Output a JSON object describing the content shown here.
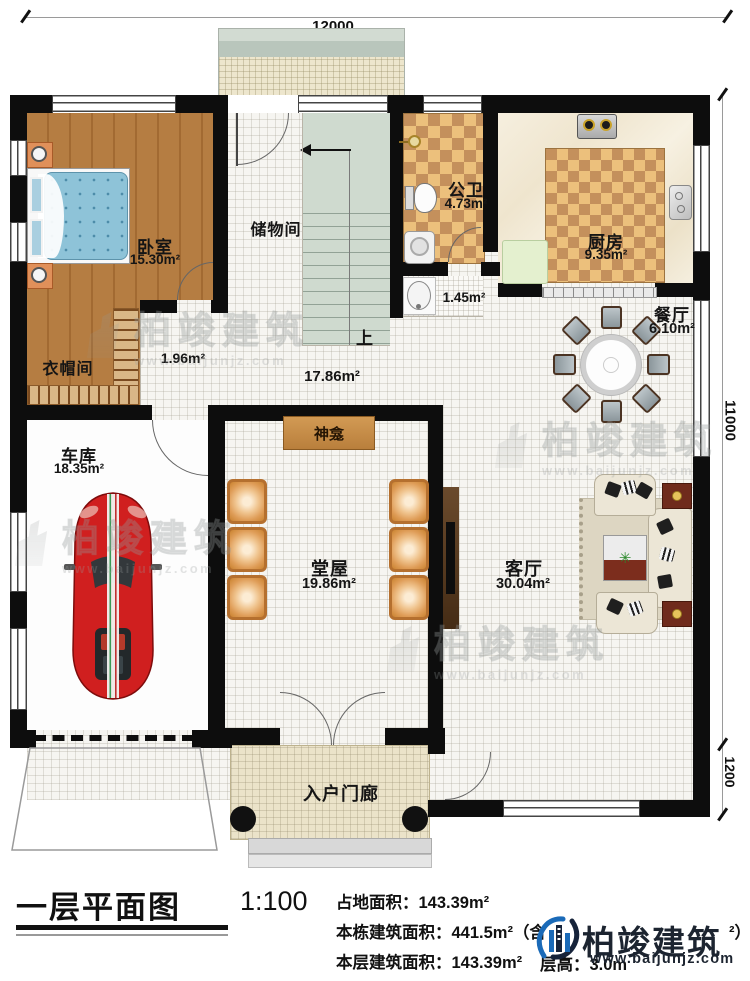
{
  "dimensions": {
    "top": "12000",
    "side_upper": "11000",
    "side_lower": "1200"
  },
  "rooms": {
    "bedroom": {
      "name": "卧室",
      "area": "15.30m²"
    },
    "cloakroom": {
      "name": "衣帽间",
      "area": "1.96m²"
    },
    "storage": {
      "name": "储物间"
    },
    "stairs": {
      "up": "上"
    },
    "bathroom": {
      "name": "公卫",
      "area": "4.73m²"
    },
    "corridor": {
      "area": "1.45m²"
    },
    "kitchen": {
      "name": "厨房",
      "area": "9.35m²"
    },
    "dining": {
      "name": "餐厅",
      "area": "6.10m²"
    },
    "hallway": {
      "area": "17.86m²"
    },
    "garage": {
      "name": "车库",
      "area": "18.35m²"
    },
    "main_hall": {
      "name": "堂屋",
      "area": "19.86m²"
    },
    "shrine": {
      "name": "神龛"
    },
    "living": {
      "name": "客厅",
      "area": "30.04m²"
    },
    "porch": {
      "name": "入户门廊"
    }
  },
  "title_block": {
    "title": "一层平面图",
    "scale": "1:100",
    "land_area_label": "占地面积：143.39m²",
    "building_area_label": "本栋建筑面积：441.5m²（含",
    "building_area_tail": "²）",
    "floor_area_label": "本层建筑面积：143.39m²",
    "floor_height_label": "层高：3.0m"
  },
  "branding": {
    "watermark_text": "柏竣建筑",
    "watermark_url": "www.baijunjz.com",
    "logo_text": "柏竣建筑",
    "logo_url": "www.baijunjz.com"
  },
  "colors": {
    "wall": "#0d0d0d",
    "wood_floor": "#b57d42",
    "checker_light": "#ecc07c",
    "checker_dark": "#c4905c",
    "stairs": "#cfdacf",
    "bed_blue": "#8ec3d8",
    "car_red": "#d01f1f",
    "logo_blue": "#1a6ab8",
    "logo_navy": "#1c2430"
  }
}
